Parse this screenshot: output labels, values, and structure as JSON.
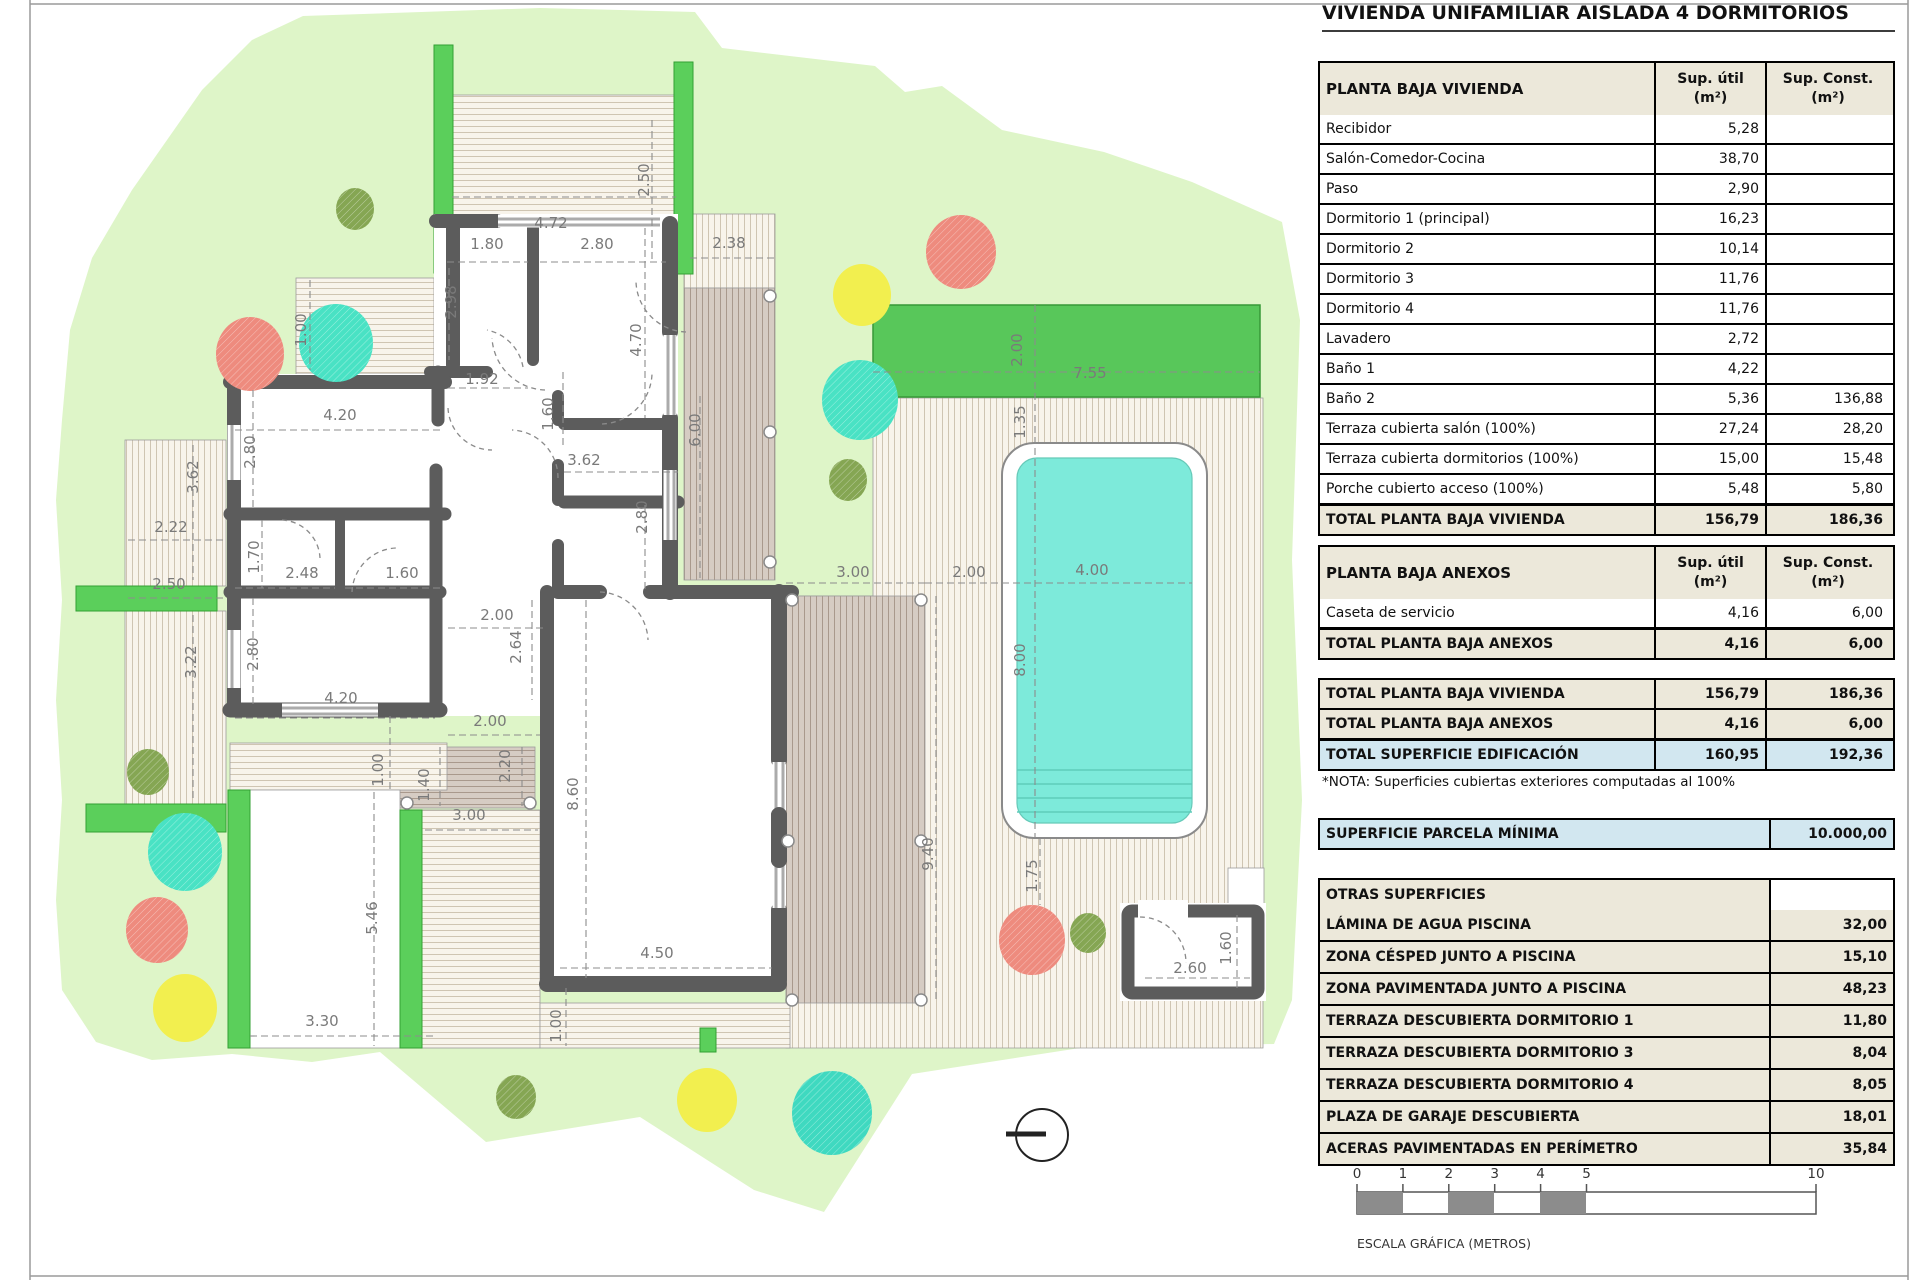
{
  "title": "VIVIENDA UNIFAMILIAR AISLADA 4 DORMITORIOS",
  "col_headers": {
    "u1": "Sup. útil",
    "u2": "(m²)",
    "c1": "Sup. Const.",
    "c2": "(m²)"
  },
  "vivienda": {
    "header": "PLANTA BAJA VIVIENDA",
    "rows": [
      {
        "l": "Recibidor",
        "u": "5,28",
        "c": ""
      },
      {
        "l": "Salón-Comedor-Cocina",
        "u": "38,70",
        "c": ""
      },
      {
        "l": "Paso",
        "u": "2,90",
        "c": ""
      },
      {
        "l": "Dormitorio 1 (principal)",
        "u": "16,23",
        "c": ""
      },
      {
        "l": "Dormitorio 2",
        "u": "10,14",
        "c": ""
      },
      {
        "l": "Dormitorio 3",
        "u": "11,76",
        "c": ""
      },
      {
        "l": "Dormitorio 4",
        "u": "11,76",
        "c": ""
      },
      {
        "l": "Lavadero",
        "u": "2,72",
        "c": ""
      },
      {
        "l": "Baño 1",
        "u": "4,22",
        "c": ""
      },
      {
        "l": "Baño 2",
        "u": "5,36",
        "c": "136,88"
      },
      {
        "l": "Terraza cubierta salón (100%)",
        "u": "27,24",
        "c": "28,20"
      },
      {
        "l": "Terraza cubierta dormitorios (100%)",
        "u": "15,00",
        "c": "15,48"
      },
      {
        "l": "Porche cubierto acceso (100%)",
        "u": "5,48",
        "c": "5,80"
      }
    ],
    "total": {
      "l": "TOTAL PLANTA BAJA VIVIENDA",
      "u": "156,79",
      "c": "186,36"
    }
  },
  "anexos": {
    "header": "PLANTA BAJA ANEXOS",
    "rows": [
      {
        "l": "Caseta de servicio",
        "u": "4,16",
        "c": "6,00"
      }
    ],
    "total": {
      "l": "TOTAL PLANTA BAJA ANEXOS",
      "u": "4,16",
      "c": "6,00"
    }
  },
  "summary": [
    {
      "l": "TOTAL PLANTA BAJA VIVIENDA",
      "u": "156,79",
      "c": "186,36",
      "blue": false
    },
    {
      "l": "TOTAL PLANTA BAJA ANEXOS",
      "u": "4,16",
      "c": "6,00",
      "blue": false
    },
    {
      "l": "TOTAL SUPERFICIE EDIFICACIÓN",
      "u": "160,95",
      "c": "192,36",
      "blue": true
    }
  ],
  "nota": "*NOTA: Superficies cubiertas exteriores computadas al 100%",
  "parcela": {
    "l": "SUPERFICIE PARCELA MÍNIMA",
    "v": "10.000,00"
  },
  "otras": {
    "header": "OTRAS SUPERFICIES",
    "rows": [
      {
        "l": "LÁMINA DE AGUA PISCINA",
        "v": "32,00"
      },
      {
        "l": "ZONA CÉSPED JUNTO A PISCINA",
        "v": "15,10"
      },
      {
        "l": "ZONA PAVIMENTADA JUNTO A PISCINA",
        "v": "48,23"
      },
      {
        "l": "TERRAZA DESCUBIERTA DORMITORIO 1",
        "v": "11,80"
      },
      {
        "l": "TERRAZA DESCUBIERTA DORMITORIO 3",
        "v": "8,04"
      },
      {
        "l": "TERRAZA DESCUBIERTA DORMITORIO 4",
        "v": "8,05"
      },
      {
        "l": "PLAZA DE GARAJE DESCUBIERTA",
        "v": "18,01"
      },
      {
        "l": "ACERAS PAVIMENTADAS EN PERÍMETRO",
        "v": "35,84"
      }
    ]
  },
  "scalebar": {
    "ticks": [
      0,
      1,
      2,
      3,
      4,
      5,
      10
    ],
    "filled": [
      [
        0,
        1
      ],
      [
        2,
        3
      ],
      [
        4,
        5
      ]
    ],
    "label": "ESCALA GRÁFICA (METROS)"
  },
  "plan": {
    "dimensions": [
      {
        "t": "4.72",
        "x": 551,
        "y": 228,
        "r": 0
      },
      {
        "t": "2.50",
        "x": 649,
        "y": 180,
        "r": 1
      },
      {
        "t": "1.80",
        "x": 487,
        "y": 249,
        "r": 0
      },
      {
        "t": "2.80",
        "x": 597,
        "y": 249,
        "r": 0
      },
      {
        "t": "2.98",
        "x": 456,
        "y": 302,
        "r": 1
      },
      {
        "t": "4.70",
        "x": 641,
        "y": 340,
        "r": 1
      },
      {
        "t": "1.92",
        "x": 482,
        "y": 384,
        "r": 0
      },
      {
        "t": "1.60",
        "x": 553,
        "y": 414,
        "r": 1
      },
      {
        "t": "1.00",
        "x": 306,
        "y": 330,
        "r": 1
      },
      {
        "t": "2.38",
        "x": 729,
        "y": 248,
        "r": 0
      },
      {
        "t": "6.00",
        "x": 700,
        "y": 430,
        "r": 1
      },
      {
        "t": "4.20",
        "x": 340,
        "y": 420,
        "r": 0
      },
      {
        "t": "2.80",
        "x": 255,
        "y": 452,
        "r": 1
      },
      {
        "t": "3.62",
        "x": 198,
        "y": 477,
        "r": 1
      },
      {
        "t": "2.22",
        "x": 171,
        "y": 532,
        "r": 0
      },
      {
        "t": "2.50",
        "x": 169,
        "y": 589,
        "r": 0
      },
      {
        "t": "3.22",
        "x": 196,
        "y": 662,
        "r": 1
      },
      {
        "t": "1.70",
        "x": 259,
        "y": 557,
        "r": 1
      },
      {
        "t": "2.48",
        "x": 302,
        "y": 578,
        "r": 0
      },
      {
        "t": "1.60",
        "x": 402,
        "y": 578,
        "r": 0
      },
      {
        "t": "2.80",
        "x": 258,
        "y": 654,
        "r": 1
      },
      {
        "t": "4.20",
        "x": 341,
        "y": 703,
        "r": 0
      },
      {
        "t": "3.62",
        "x": 584,
        "y": 465,
        "r": 0
      },
      {
        "t": "2.80",
        "x": 647,
        "y": 517,
        "r": 1
      },
      {
        "t": "2.00",
        "x": 497,
        "y": 620,
        "r": 0
      },
      {
        "t": "2.64",
        "x": 521,
        "y": 647,
        "r": 1
      },
      {
        "t": "2.00",
        "x": 490,
        "y": 726,
        "r": 0
      },
      {
        "t": "2.20",
        "x": 510,
        "y": 766,
        "r": 1
      },
      {
        "t": "1.40",
        "x": 429,
        "y": 785,
        "r": 1
      },
      {
        "t": "1.00",
        "x": 383,
        "y": 770,
        "r": 1
      },
      {
        "t": "3.00",
        "x": 469,
        "y": 820,
        "r": 0
      },
      {
        "t": "5.46",
        "x": 377,
        "y": 918,
        "r": 1
      },
      {
        "t": "3.30",
        "x": 322,
        "y": 1026,
        "r": 0
      },
      {
        "t": "8.60",
        "x": 578,
        "y": 794,
        "r": 1
      },
      {
        "t": "4.50",
        "x": 657,
        "y": 958,
        "r": 0
      },
      {
        "t": "1.00",
        "x": 561,
        "y": 1026,
        "r": 1
      },
      {
        "t": "3.00",
        "x": 853,
        "y": 577,
        "r": 0
      },
      {
        "t": "2.00",
        "x": 969,
        "y": 577,
        "r": 0
      },
      {
        "t": "9.40",
        "x": 933,
        "y": 854,
        "r": 1
      },
      {
        "t": "1.75",
        "x": 1037,
        "y": 876,
        "r": 1
      },
      {
        "t": "2.00",
        "x": 1022,
        "y": 350,
        "r": 1
      },
      {
        "t": "7.55",
        "x": 1090,
        "y": 378,
        "r": 0
      },
      {
        "t": "1.35",
        "x": 1025,
        "y": 422,
        "r": 1
      },
      {
        "t": "4.00",
        "x": 1092,
        "y": 575,
        "r": 0
      },
      {
        "t": "8.00",
        "x": 1025,
        "y": 660,
        "r": 1
      },
      {
        "t": "2.60",
        "x": 1190,
        "y": 973,
        "r": 0
      },
      {
        "t": "1.60",
        "x": 1231,
        "y": 948,
        "r": 1
      }
    ],
    "colors": {
      "grass": "#def5c8",
      "hedge": "#5bcf5b",
      "hedge_stroke": "#33a033",
      "pergola": "#58c75a",
      "wall": "#5c5c5c",
      "deck_bg": "#f8f4eb",
      "deck_line": "#cfc5b2",
      "deck_brown_bg": "#d6ccc3",
      "deck_brown_line": "#a9998c",
      "pool_water": "#7deada",
      "pool_step": "#5eccba",
      "tree_red": "#ee8b7e",
      "tree_teal": "#49e2c4",
      "tree_yellow": "#f2ef4f",
      "tree_olive": "#85a653",
      "dim_text": "#7a7a7a",
      "table_beige": "#ece8da",
      "table_blue": "#d2e7f0",
      "scale_fill": "#8c8c8c"
    }
  }
}
